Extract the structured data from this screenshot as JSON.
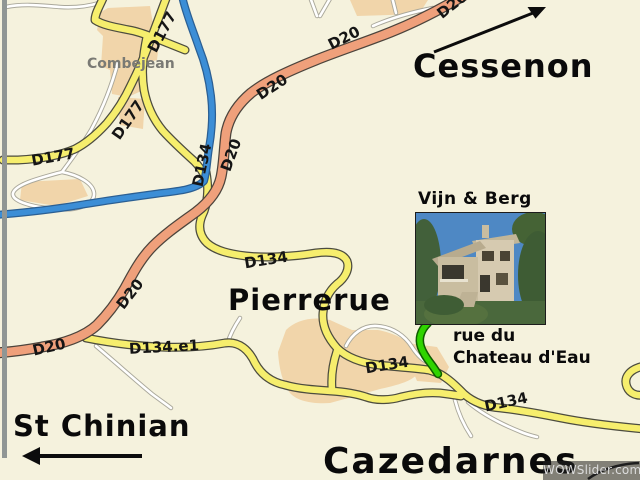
{
  "map": {
    "region": "Pierrerue area road map",
    "colors": {
      "background": "#f5f2dd",
      "yellow_road": "#f6ee6d",
      "orange_road": "#efa07b",
      "blue_river": "#3c8ed6",
      "green_road": "#2fd400",
      "village_fill": "#f1d5aa",
      "minor_road": "#ffffff",
      "border_bar": "#909694"
    }
  },
  "places": {
    "combejean": {
      "label": "Combejean"
    },
    "cessenon": {
      "label": "Cessenon"
    },
    "pierrerue": {
      "label": "Pierrerue"
    },
    "st_chinian": {
      "label": "St Chinian"
    },
    "cazedarnes": {
      "label": "Cazedarnes"
    }
  },
  "poi": {
    "name": "Vijn & Berg",
    "street": "rue du\nChateau d'Eau",
    "photo_description": "house-photo"
  },
  "road_labels": [
    {
      "text": "D177",
      "x": 162,
      "y": 32,
      "rot": -62
    },
    {
      "text": "D177",
      "x": 128,
      "y": 120,
      "rot": -55
    },
    {
      "text": "D177",
      "x": 53,
      "y": 157,
      "rot": -10
    },
    {
      "text": "D20",
      "x": 452,
      "y": 5,
      "rot": -38
    },
    {
      "text": "D20",
      "x": 344,
      "y": 38,
      "rot": -27
    },
    {
      "text": "D20",
      "x": 272,
      "y": 87,
      "rot": -33
    },
    {
      "text": "D20",
      "x": 231,
      "y": 155,
      "rot": -70
    },
    {
      "text": "D20",
      "x": 130,
      "y": 294,
      "rot": -52
    },
    {
      "text": "D20",
      "x": 49,
      "y": 347,
      "rot": -13
    },
    {
      "text": "D134",
      "x": 202,
      "y": 165,
      "rot": -78
    },
    {
      "text": "D134",
      "x": 266,
      "y": 260,
      "rot": -9
    },
    {
      "text": "D134",
      "x": 387,
      "y": 365,
      "rot": -9
    },
    {
      "text": "D134",
      "x": 506,
      "y": 402,
      "rot": -12
    },
    {
      "text": "D134.e1",
      "x": 164,
      "y": 347,
      "rot": -3
    }
  ],
  "watermark": {
    "text": "WOWSlider.com"
  }
}
